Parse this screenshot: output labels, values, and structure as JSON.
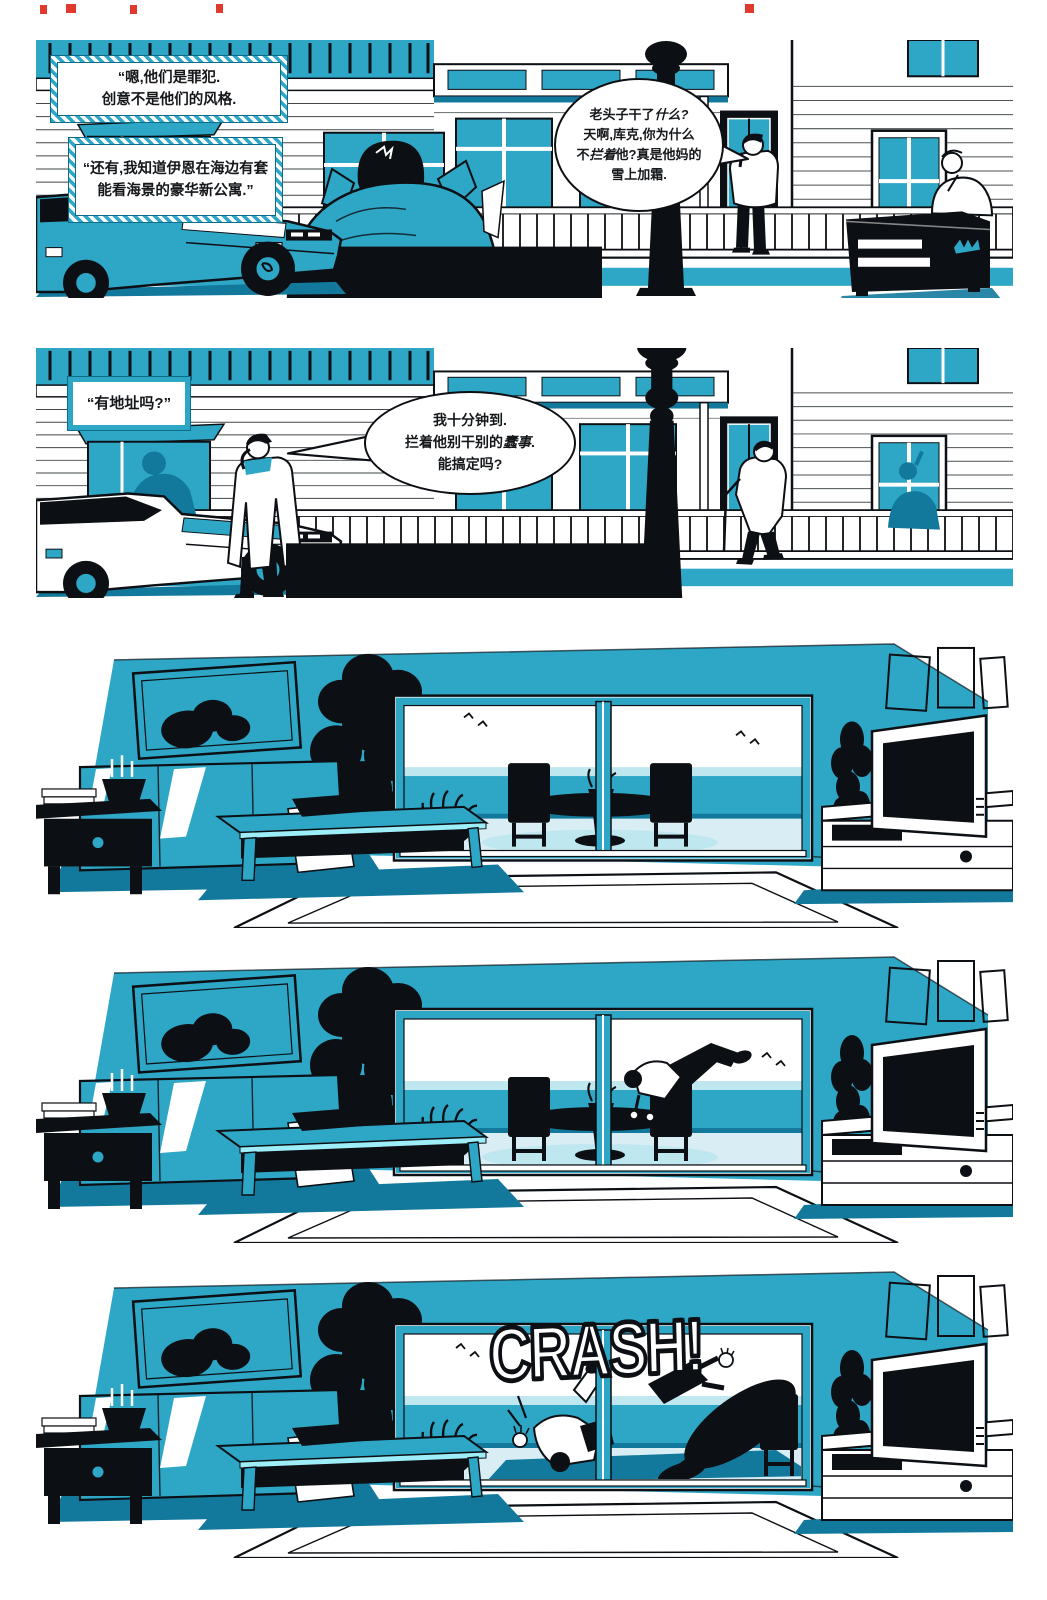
{
  "colors": {
    "teal": "#2ea6c6",
    "tealdark": "#12799c",
    "tealbright": "#9deef8",
    "tealband": "#bfe7f0",
    "tealpale": "#d9eef4",
    "ink": "#0c0f13",
    "capline": "#0b6c8a",
    "paper": "#ffffff"
  },
  "panel1": {
    "caption1": "“嗯,他们是罪犯.\n创意不是他们的风格.",
    "caption2": "“还有,我知道伊恩在海边有套\n能看海景的豪华新公寓.”",
    "bubble": "老头子干了**什么?**\n天啊,库克,你为什么\n不**拦着**他?真是他妈的\n雪上加霜."
  },
  "panel2": {
    "caption": "“有地址吗?”",
    "bubble": "我十分钟到.\n拦着他别干别的**蠢事**.\n能搞定吗?"
  },
  "panel5": {
    "sfx": "CRASH!"
  }
}
